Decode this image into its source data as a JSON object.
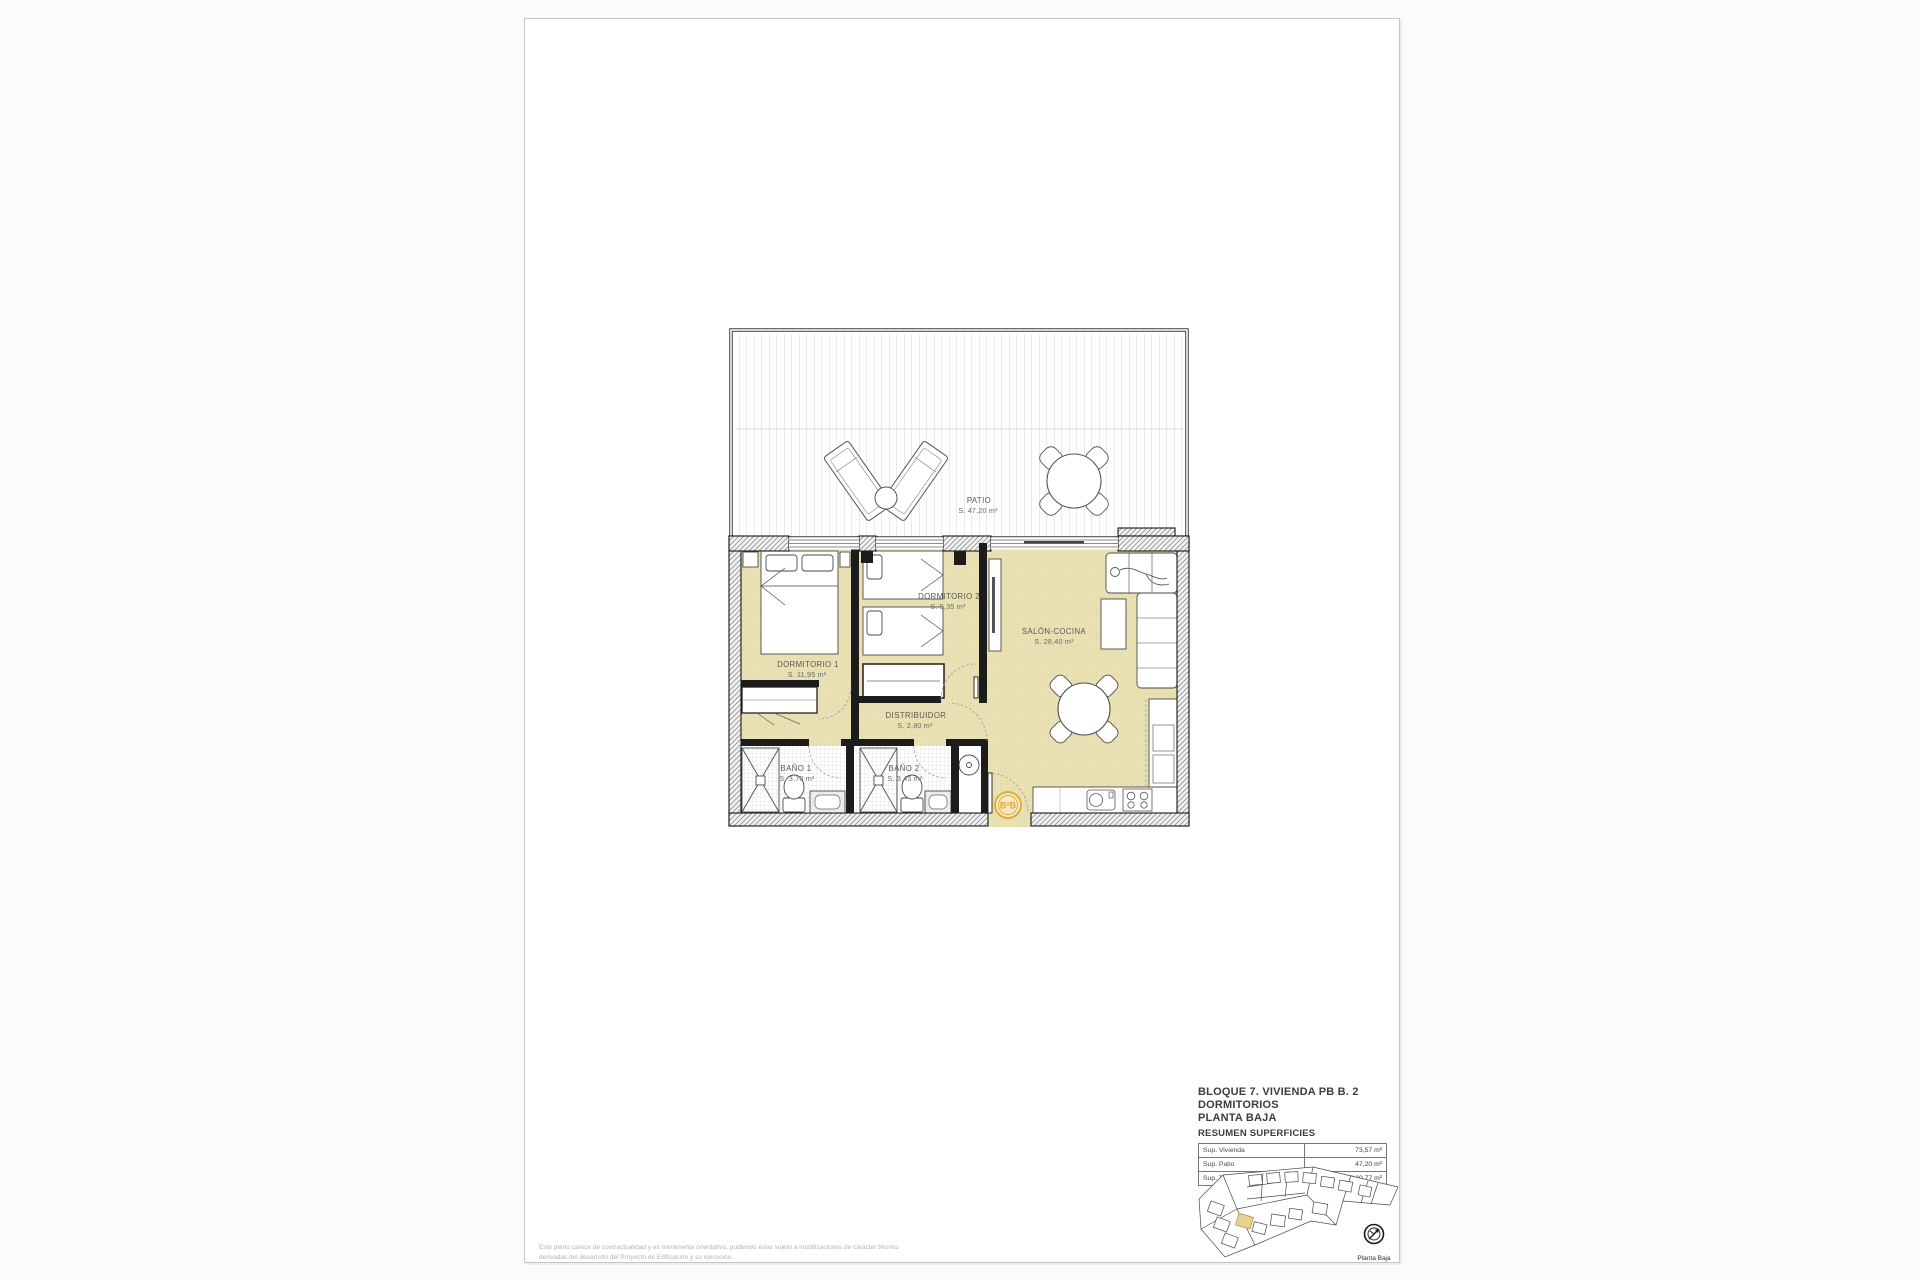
{
  "document": {
    "type": "architectural-floor-plan",
    "sheet_background": "#ffffff"
  },
  "floor_plan": {
    "rooms": {
      "patio": {
        "name": "PATIO",
        "area": "S. 47,20 m²"
      },
      "dormitorio1": {
        "name": "DORMITORIO 1",
        "area": "S. 11,95 m²"
      },
      "dormitorio2": {
        "name": "DORMITORIO 2",
        "area": "S. 9,35 m²"
      },
      "salon_cocina": {
        "name": "SALÓN-COCINA",
        "area": "S. 28,40 m²"
      },
      "distribuidor": {
        "name": "DISTRIBUIDOR",
        "area": "S. 2,80 m²"
      },
      "bano1": {
        "name": "BAÑO 1",
        "area": "S. 3,70 m²"
      },
      "bano2": {
        "name": "BAÑO 2",
        "area": "S. 3,45 m²"
      }
    },
    "entrance_marker": "BºB"
  },
  "title_block": {
    "line1": "BLOQUE 7. VIVIENDA PB B. 2 DORMITORIOS",
    "line2": "PLANTA BAJA",
    "line3": "RESUMEN SUPERFICIES",
    "table": {
      "rows": [
        {
          "label": "Sup. Vivienda",
          "value": "73,57 m²"
        },
        {
          "label": "Sup. Patio",
          "value": "47,20 m²"
        },
        {
          "label": "Sup. Total",
          "value": "120,77 m²"
        }
      ]
    }
  },
  "key_plan": {
    "caption": "Planta Baja"
  },
  "disclaimer": "Este plano carece de contractualidad y es meramente orientativo, pudiendo estar sujeto a modificaciones de carácter técnico derivadas del desarrollo del Proyecto de Edificación y su ejecución.",
  "colors": {
    "room_fill": "#e9e1b3",
    "accent_orange": "#e3a72e",
    "wall": "#1c1c1c",
    "tile_line": "#d4d4d4"
  }
}
